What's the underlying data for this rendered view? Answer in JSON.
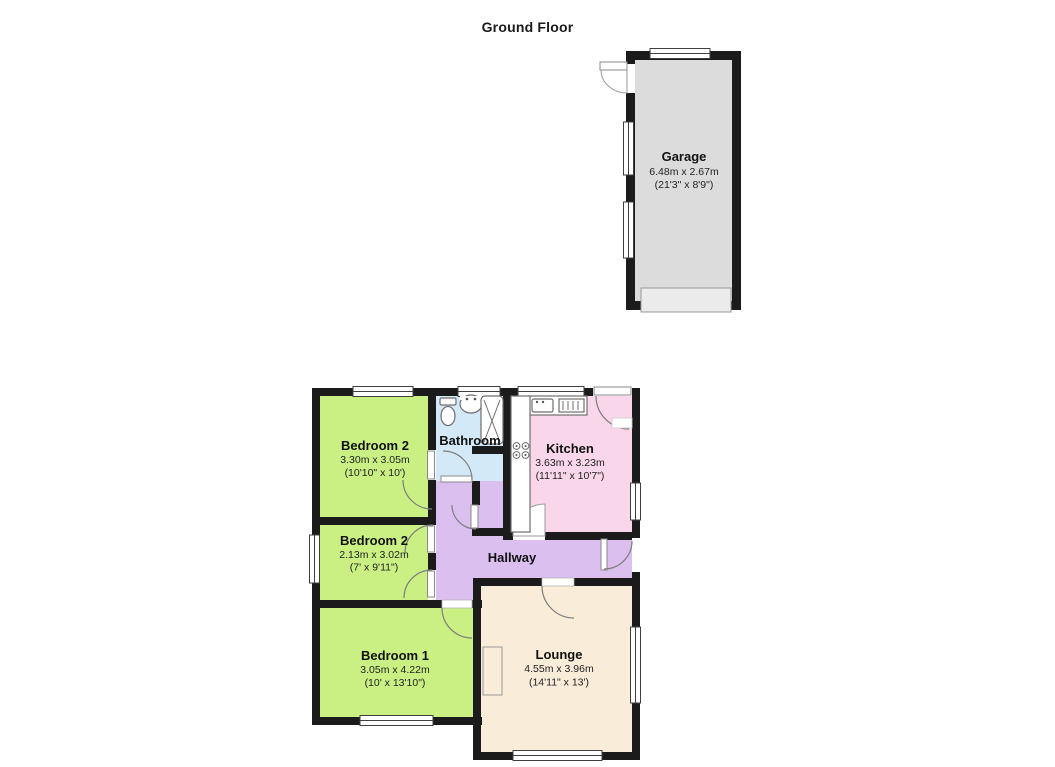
{
  "title": "Ground Floor",
  "colors": {
    "wall": "#1b1b1b",
    "bedroom": "#caf084",
    "bathroom": "#d4e9f8",
    "kitchen": "#f9d6e9",
    "hallway": "#dabfef",
    "lounge": "#f9ecd9",
    "garage": "#dcdcdc",
    "garage_door": "#ebebeb"
  },
  "rooms": {
    "garage": {
      "name": "Garage",
      "dims_m": "6.48m x 2.67m",
      "dims_ft": "(21'3\" x 8'9\")"
    },
    "bedroom2a": {
      "name": "Bedroom 2",
      "dims_m": "3.30m x 3.05m",
      "dims_ft": "(10'10\" x 10')"
    },
    "bathroom": {
      "name": "Bathroom"
    },
    "kitchen": {
      "name": "Kitchen",
      "dims_m": "3.63m x 3.23m",
      "dims_ft": "(11'11\" x 10'7\")"
    },
    "bedroom2b": {
      "name": "Bedroom 2",
      "dims_m": "2.13m x 3.02m",
      "dims_ft": "(7' x 9'11\")"
    },
    "hallway": {
      "name": "Hallway"
    },
    "bedroom1": {
      "name": "Bedroom 1",
      "dims_m": "3.05m x 4.22m",
      "dims_ft": "(10' x 13'10\")"
    },
    "lounge": {
      "name": "Lounge",
      "dims_m": "4.55m x 3.96m",
      "dims_ft": "(14'11\" x 13')"
    }
  }
}
